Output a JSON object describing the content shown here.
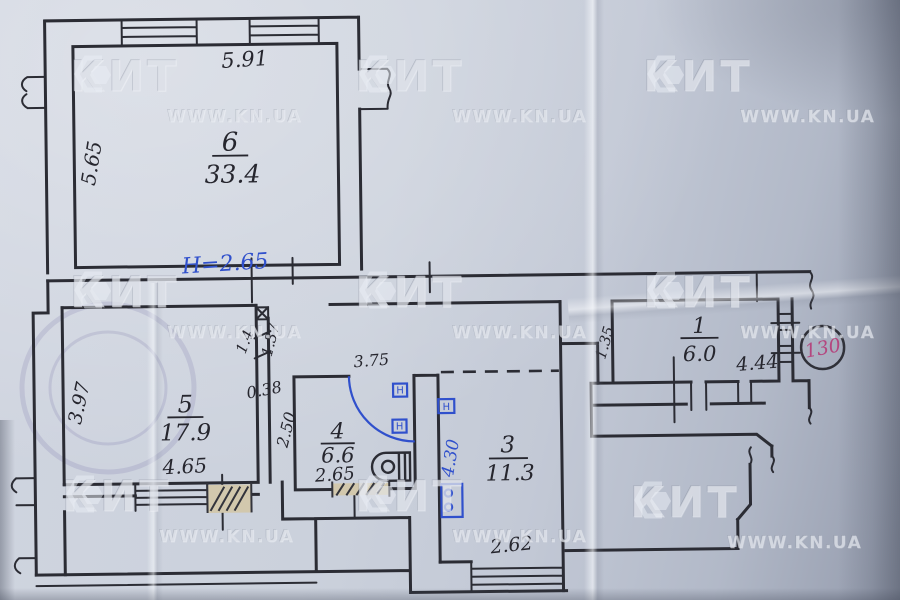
{
  "document": {
    "type": "apartment floor plan sketch",
    "ink_color": "#2b2c34",
    "blue_ink": "#3050cc",
    "red_ink": "#b4477f",
    "paper_color": "#c9cfda"
  },
  "watermark": {
    "logo": "КИТ",
    "url": "WWW.KN.UA"
  },
  "stamp_number": {
    "value": "130"
  },
  "height_note": {
    "value": "H=2.65"
  },
  "rooms": {
    "r6": {
      "number": "6",
      "area": "33.4"
    },
    "r5": {
      "number": "5",
      "area": "17.9"
    },
    "r4": {
      "number": "4",
      "area": "6.6"
    },
    "r3": {
      "number": "3",
      "area": "11.3"
    },
    "r1": {
      "number": "1",
      "area": "6.0"
    }
  },
  "dims": {
    "room6_top": "5.91",
    "room6_left": "5.65",
    "room5_left": "3.97",
    "room5_bottom": "4.65",
    "pier_width": "0.38",
    "room4_left": "2.50",
    "opening_a": "1.4",
    "opening_b": "1.37",
    "hall_top": "3.75",
    "room4_bottom": "2.65",
    "room3_left_blue": "4.30",
    "room3_bottom": "2.62",
    "room1_left": "1.35",
    "room1_bottom": "4.44",
    "radiator_letter": "Н"
  }
}
